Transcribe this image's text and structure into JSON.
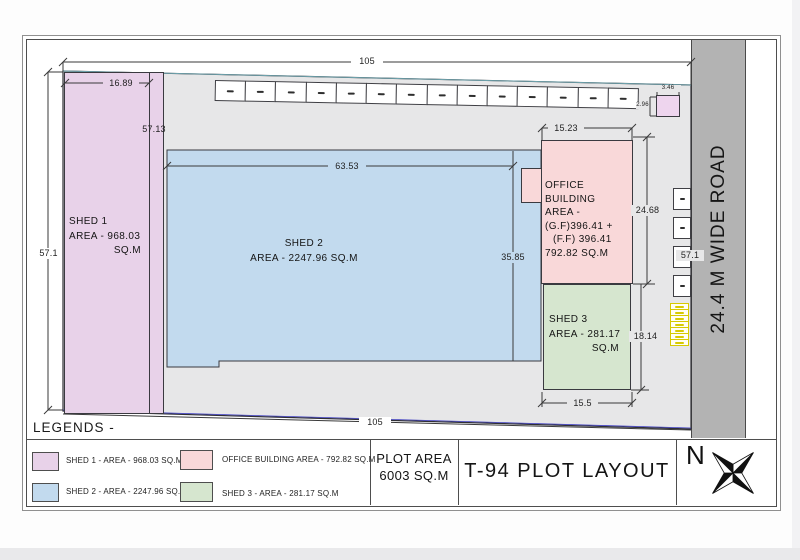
{
  "sheet": {
    "legends_heading": "LEGENDS -"
  },
  "title_block": {
    "plot_area_line1": "PLOT AREA",
    "plot_area_line2": "6003 SQ.M",
    "title": "T-94 PLOT LAYOUT",
    "north": "N"
  },
  "road": {
    "label": "24.4 M WIDE ROAD"
  },
  "legends": {
    "items": [
      {
        "label": "SHED 1 - AREA - 968.03 SQ.M",
        "color": "#e8d2e9"
      },
      {
        "label": "SHED 2 - AREA - 2247.96 SQ.M",
        "color": "#c2daee"
      },
      {
        "label": "OFFICE BUILDING AREA - 792.82 SQ.M",
        "color": "#f9d8d9"
      },
      {
        "label": "SHED 3 - AREA - 281.17 SQ.M",
        "color": "#d6e6cf"
      }
    ]
  },
  "buildings": {
    "shed1": {
      "name": "SHED 1",
      "area_line1": "AREA - 968.03",
      "area_line2": "SQ.M"
    },
    "shed2": {
      "name": "SHED 2",
      "area": "AREA - 2247.96 SQ.M"
    },
    "shed3": {
      "name": "SHED 3",
      "area_line1": "AREA - 281.17",
      "area_line2": "SQ.M"
    },
    "office": {
      "lines": [
        "OFFICE BUILDING",
        "AREA -",
        "(G.F)396.41 +",
        "(F.F) 396.41",
        "792.82 SQ.M"
      ]
    }
  },
  "dimensions": {
    "top_width": "105",
    "bottom_width": "105",
    "left_height": "57.1",
    "right_height": "57.1",
    "shed1_width": "16.89",
    "shed1_height": "57.13",
    "shed2_width": "63.53",
    "shed2_height": "35.85",
    "office_width": "15.23",
    "office_height": "24.68",
    "shed3_height": "18.14",
    "shed3_width": "15.5",
    "utility_box_width": "3.46",
    "utility_box_height": "2.96"
  },
  "site": {
    "parking_stalls_top": 14,
    "stalls_right": 4,
    "yellow_cells": 7
  },
  "colors": {
    "shed1": "#e8d2e9",
    "shed2": "#c2daee",
    "shed3": "#d6e6cf",
    "office": "#f9d8d9",
    "utility_box": "#eed5ee",
    "road": "#b3b3b3",
    "plot": "#e7e7e8",
    "yellow": "#d7ca00"
  }
}
